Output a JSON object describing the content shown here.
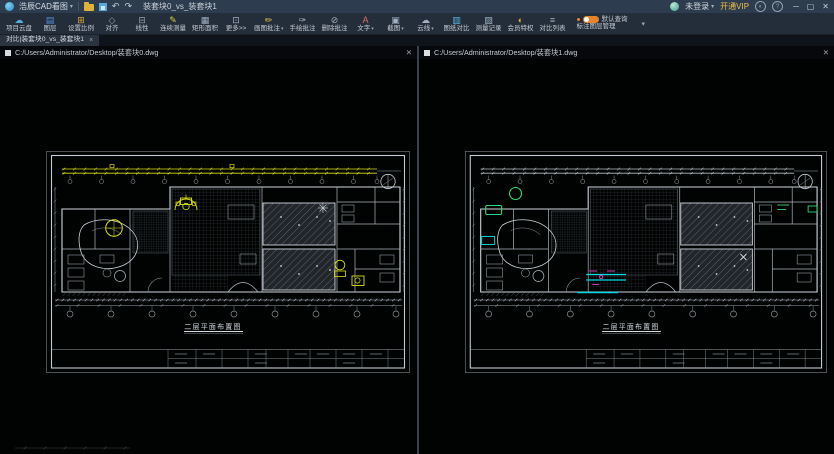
{
  "titlebar": {
    "app_name": "浩辰CAD看图",
    "app_caret": "▾",
    "undo_icon": "↶",
    "redo_icon": "↷",
    "doc_title": "装套块0_vs_装套块1",
    "login_label": "未登录",
    "login_caret": "▾",
    "vip_label": "开通VIP",
    "theme_icon_glyph": "◐",
    "help_icon_glyph": "?",
    "window_controls": {
      "minimize": "─",
      "maximize": "▢",
      "close": "✕"
    }
  },
  "toolbar": {
    "items": [
      {
        "label": "项目云盘",
        "icon": "☁",
        "icon_color": "#56aee0",
        "caret": false
      },
      {
        "label": "图层",
        "icon": "▤",
        "icon_color": "#568ee0",
        "caret": false
      },
      {
        "label": "设置比例",
        "icon": "⊞",
        "icon_color": "#d9aa3c",
        "caret": false
      },
      {
        "label": "对齐",
        "icon": "◇",
        "icon_color": "#8fa0b0",
        "caret": false
      },
      {
        "label": "线性",
        "icon": "⊟",
        "icon_color": "#8fa0b0",
        "caret": false
      },
      {
        "label": "连续测量",
        "icon": "✎",
        "icon_color": "#d9cf3c",
        "caret": false
      },
      {
        "label": "矩形面积",
        "icon": "▦",
        "icon_color": "#9fb0c0",
        "caret": false
      },
      {
        "label": "更多>>",
        "icon": "⊡",
        "icon_color": "#9fb0c0",
        "caret": false
      },
      {
        "label": "画图批注",
        "icon": "✏",
        "icon_color": "#e0c33c",
        "caret": true
      },
      {
        "label": "手绘批注",
        "icon": "✑",
        "icon_color": "#9fb0c0",
        "caret": false
      },
      {
        "label": "删除批注",
        "icon": "⊘",
        "icon_color": "#9fb0c0",
        "caret": false
      },
      {
        "label": "文字",
        "icon": "A",
        "icon_color": "#e06a5a",
        "caret": true
      },
      {
        "label": "截图",
        "icon": "▣",
        "icon_color": "#9fb0c0",
        "caret": true
      },
      {
        "label": "云线",
        "icon": "☁",
        "icon_color": "#9fb0c0",
        "caret": true
      },
      {
        "label": "图纸对比",
        "icon": "▥",
        "icon_color": "#58b7e8",
        "caret": false
      },
      {
        "label": "测量记录",
        "icon": "▨",
        "icon_color": "#9fb0c0",
        "caret": false
      },
      {
        "label": "会员特权",
        "icon": "◐",
        "icon_color": "#e0a43c",
        "caret": false
      },
      {
        "label": "对比列表",
        "icon": "≡",
        "icon_color": "#9fb0c0",
        "caret": false
      }
    ],
    "toggle_label": "默认查询",
    "layer_manager_label": "标注图层管理",
    "dropdown_caret": "▾"
  },
  "tabbar": {
    "active_tab": "对比|装套块0_vs_装套块1",
    "close_glyph": "×"
  },
  "panes": [
    {
      "path": "C:/Users/Administrator/Desktop/装套块0.dwg",
      "drawing_title": "二层平面布置图",
      "variant": "A",
      "close_glyph": "✕"
    },
    {
      "path": "C:/Users/Administrator/Desktop/装套块1.dwg",
      "drawing_title": "二层平面布置图",
      "variant": "B",
      "close_glyph": "✕"
    }
  ],
  "colors": {
    "highlight_changed": "#dde012",
    "highlight_added": "#2fd977",
    "highlight_moved": "#00dbe3",
    "highlight_modified": "#d943c8",
    "accent_orange": "#e8832a"
  }
}
